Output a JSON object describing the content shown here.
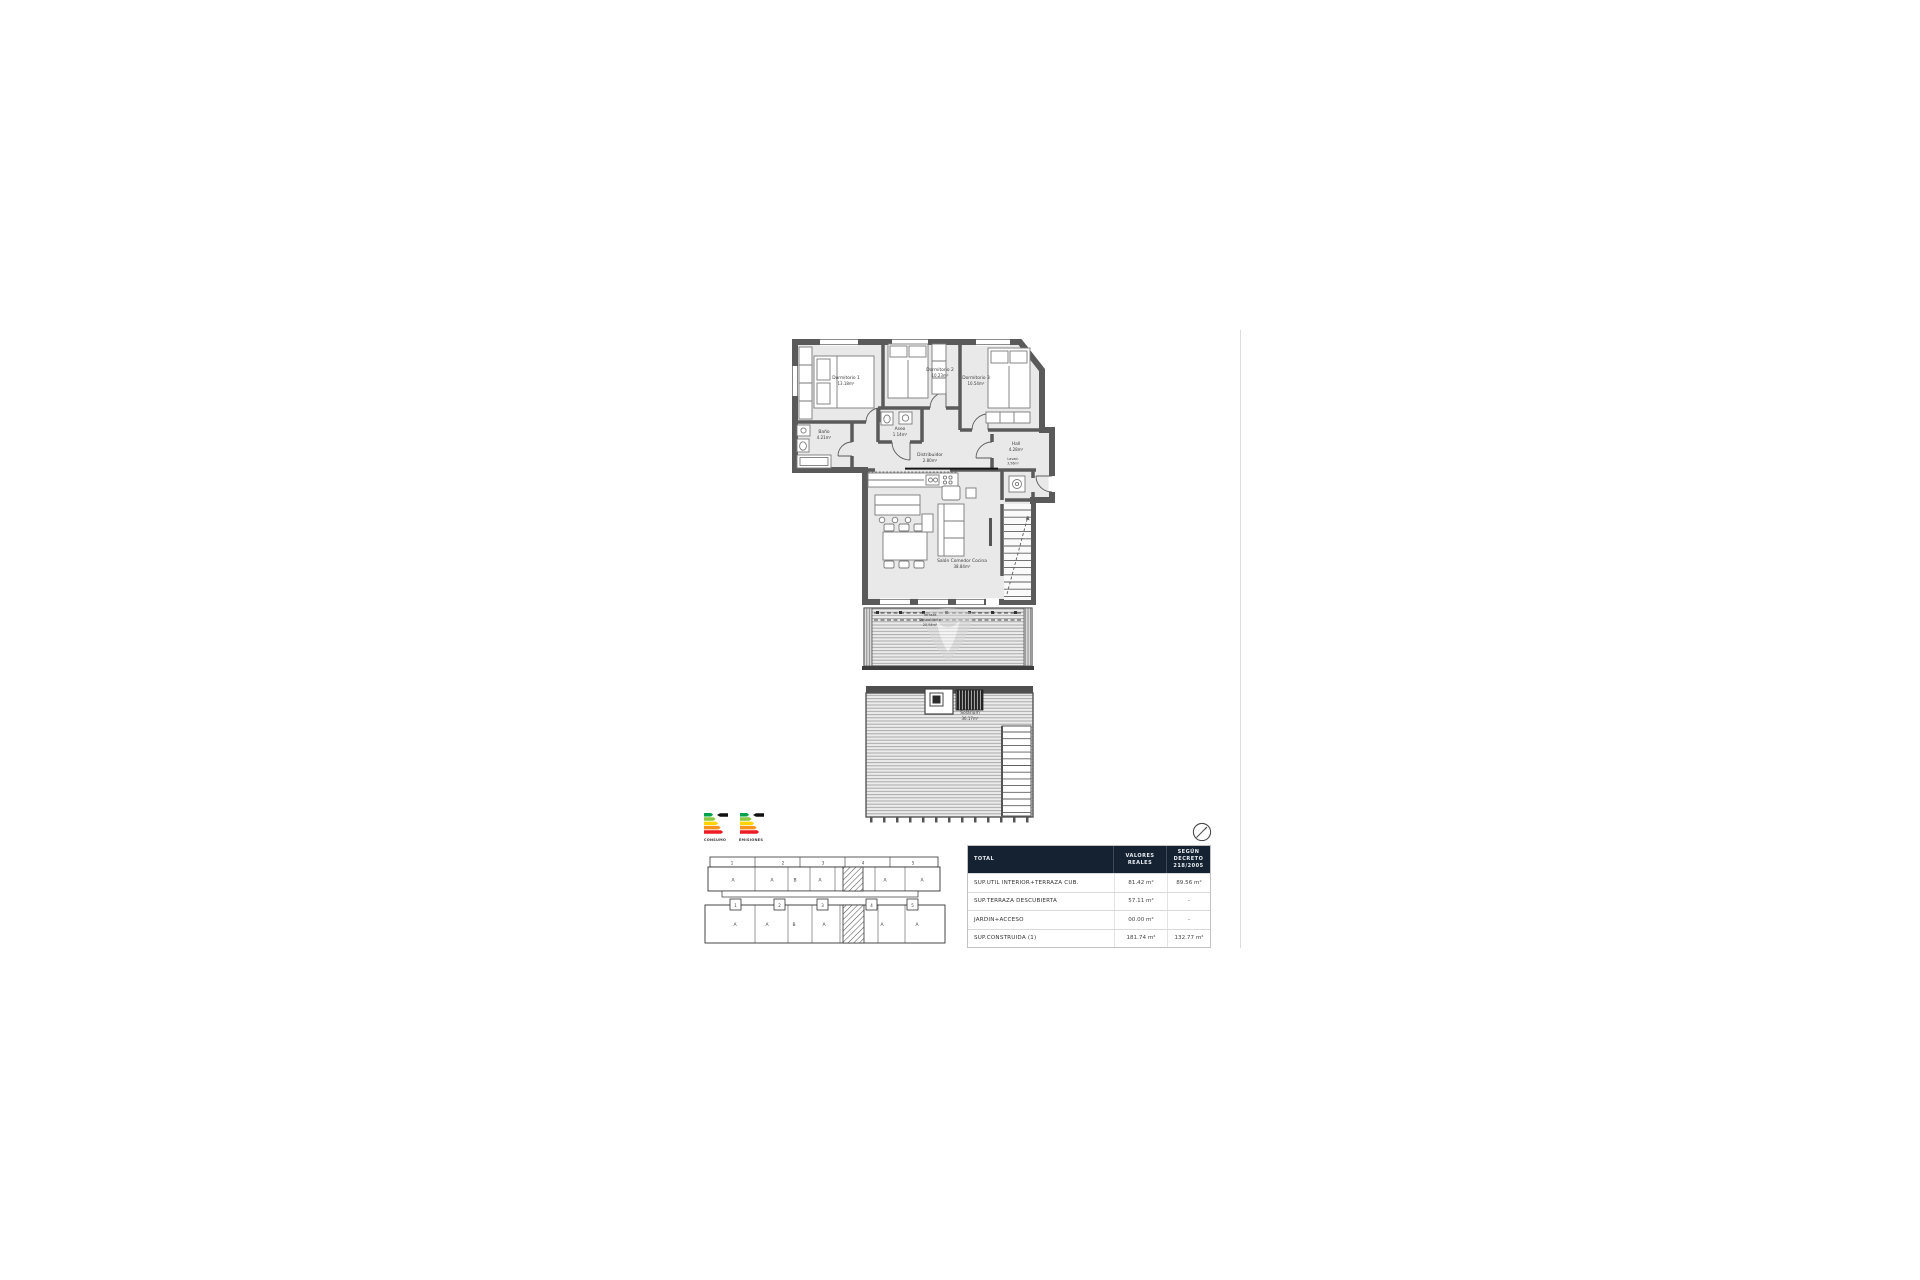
{
  "colors": {
    "wall": "#5a5a5a",
    "room_fill": "#e9e9e9",
    "table_header_bg": "#152231",
    "hatch": "#444444",
    "energy_scale": [
      "#00a14b",
      "#8dc63f",
      "#ffd400",
      "#f7941d",
      "#ed1c24"
    ]
  },
  "floor_plan": {
    "rooms": [
      {
        "name": "Dormitorio 1",
        "area": "13.18m²"
      },
      {
        "name": "Dormitorio 2",
        "area": "10.23m²"
      },
      {
        "name": "Dormitorio 3",
        "area": "10.54m²"
      },
      {
        "name": "Baño",
        "area": "4.21m²"
      },
      {
        "name": "Aseo",
        "area": "1.14m²"
      },
      {
        "name": "Distribuidor",
        "area": "2.80m²"
      },
      {
        "name": "Hall",
        "area": "4.28m²"
      },
      {
        "name": "Lavad.",
        "area": "3.56m²"
      },
      {
        "name": "Salón Comedor Cocina",
        "area": "38.84m²"
      },
      {
        "name": "Terraza",
        "name2": "Descubierta",
        "area": "20.94m²"
      },
      {
        "name": "Solárium",
        "area": "36.17m²"
      }
    ]
  },
  "energy": {
    "consumo_label": "CONSUMO",
    "emisiones_label": "EMISIONES"
  },
  "site_plan": {
    "rows": [
      {
        "portals": [
          "1",
          "2",
          "3",
          "4",
          "5"
        ],
        "units": [
          "A",
          "A",
          "B",
          "A",
          "A",
          "A"
        ]
      },
      {
        "portals": [
          "1",
          "2",
          "3",
          "4",
          "5"
        ],
        "units": [
          "A",
          "A",
          "B",
          "A",
          "A",
          "A"
        ]
      }
    ]
  },
  "table": {
    "header": {
      "total": "TOTAL",
      "valores": "VALORES REALES",
      "decreto": "SEGÚN DECRETO 218/2005"
    },
    "rows": [
      {
        "label": "SUP.UTIL INTERIOR+TERRAZA CUB.",
        "real": "81.42 m²",
        "decreto": "89.56 m²"
      },
      {
        "label": "SUP.TERRAZA DESCUBIERTA",
        "real": "57.11 m²",
        "decreto": "-"
      },
      {
        "label": "JARDIN+ACCESO",
        "real": "00.00 m²",
        "decreto": "-"
      },
      {
        "label": "SUP.CONSTRUIDA (1)",
        "real": "181.74 m²",
        "decreto": "132.77 m²"
      }
    ]
  }
}
